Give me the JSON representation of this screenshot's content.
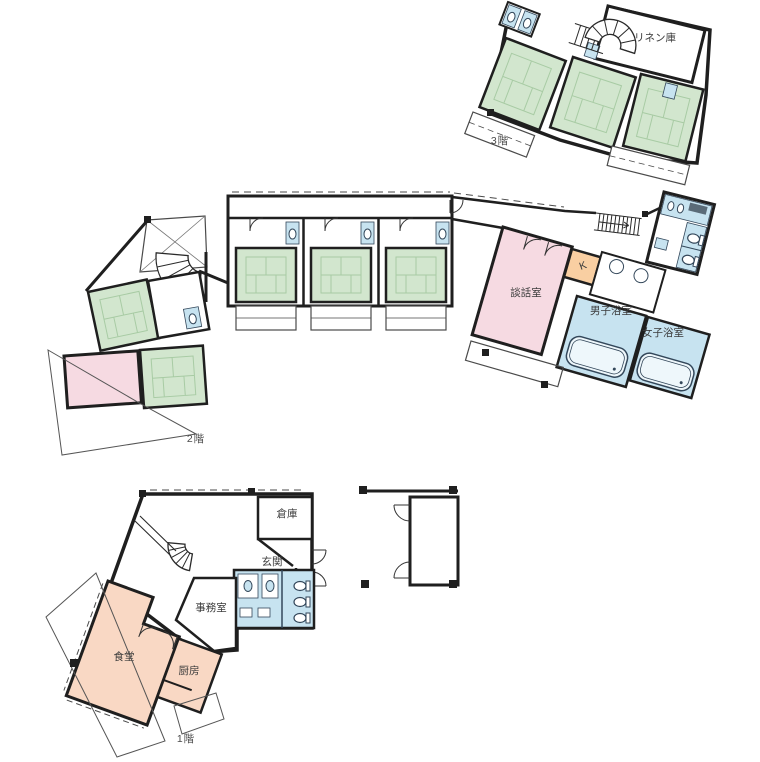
{
  "document": {
    "type": "building-floor-plan",
    "background": "#ffffff"
  },
  "colors": {
    "wall": "#1f1f1f",
    "thin_line": "#555555",
    "tatami_green": "#d2e6ce",
    "tatami_line": "#a8cba4",
    "pink_room": "#f6dae2",
    "peach_room": "#f9d8c4",
    "orange_room": "#f9cfa2",
    "water_blue": "#c7e3f0",
    "label_text": "#3b3b3b"
  },
  "floors": {
    "f3": {
      "label": "3階",
      "rooms": {
        "linen": "リネン庫"
      }
    },
    "f2": {
      "label": "2階",
      "rooms": {
        "lounge": "談話室",
        "kitchenette": "K",
        "mens_bath": "男子浴室",
        "womens_bath": "女子浴室"
      }
    },
    "f1": {
      "label": "1階",
      "rooms": {
        "dining": "食堂",
        "kitchen": "厨房",
        "office": "事務室",
        "entrance": "玄関",
        "storage": "倉庫"
      }
    }
  }
}
